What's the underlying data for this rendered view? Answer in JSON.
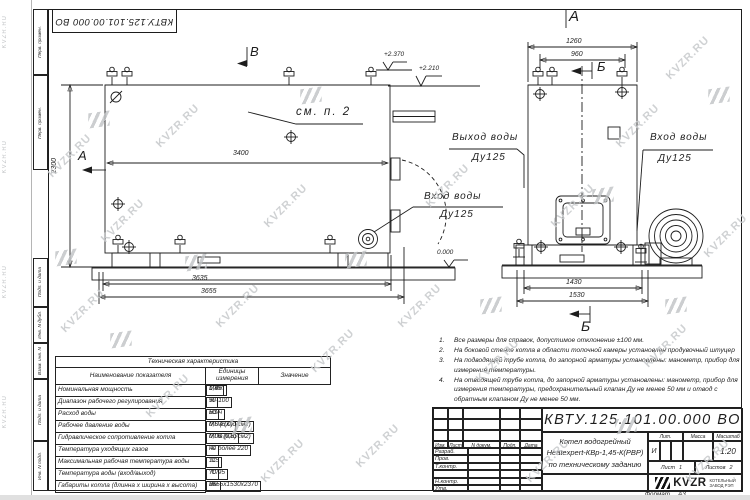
{
  "watermark": "KVZR.RU",
  "top_stamp": {
    "doc_number": "КВТУ.125.101.00.000  ВО"
  },
  "margin_labels": [
    "Перв. примен.",
    "Перв. примен.",
    "Подп. и дата",
    "Инв. N дубл.",
    "Взам. инв. N",
    "Подп. и дата",
    "Инв. N подл."
  ],
  "left_view": {
    "mark_a": "А",
    "mark_v": "В",
    "see_note": "см. п. 2",
    "elev_high": "+2.370",
    "elev_mid": "+2.210",
    "elev_zero": "0.000",
    "inlet_label": "Вход воды",
    "inlet_dn": "Ду125",
    "dim_height": "2300",
    "dim_3400": "3400",
    "dim_3635": "3635",
    "dim_3655": "3655"
  },
  "right_view": {
    "view_label": "А",
    "section_top": "Б",
    "section_bottom": "Б",
    "outlet_label": "Выход воды",
    "outlet_dn": "Ду125",
    "inlet_label": "Вход воды",
    "inlet_dn": "Ду125",
    "dim_1260": "1260",
    "dim_960": "960",
    "dim_1430": "1430",
    "dim_1530": "1530"
  },
  "tech_table": {
    "title": "Техническая характеристика",
    "headers": [
      "Наименование показателя",
      "Единицы измерения",
      "Значение"
    ],
    "rows": [
      [
        "Номинальная мощность",
        "МВт",
        "1,45"
      ],
      [
        "Диапазон рабочего регулирования",
        "%",
        "50-100"
      ],
      [
        "Расход воды",
        "м3/ч",
        "50"
      ],
      [
        "Рабочее давление воды",
        "МПа (кгс/см2)",
        "0,6 (6,0)"
      ],
      [
        "Гидравлическое сопротивление котла",
        "МПа (кгс/см2)",
        "0,06 (0,6)"
      ],
      [
        "Температура уходящих газов",
        "°С",
        "не более 220"
      ],
      [
        "Максимальная рабочая температура воды",
        "°С",
        "115"
      ],
      [
        "Температура воды (вход/выход)",
        "°С",
        "70/95"
      ],
      [
        "Габариты котла (длинна х ширина х высота)",
        "мм",
        "3655х1530х2370"
      ]
    ]
  },
  "notes": [
    {
      "n": "1.",
      "text": "Все размеры для справок, допустимое отклонение ±100 мм."
    },
    {
      "n": "2.",
      "text": "На боковой стенке котла в области топочной камеры установлен продувочный штуцер"
    },
    {
      "n": "3.",
      "text": "На  подводящей трубе котла, до запорной арматуры установлены: манометр, прибор для измерения температуры."
    },
    {
      "n": "4.",
      "text": "На отводящей трубе котла, до запорной арматуры установлены: манометр, прибор для измерения температуры, предохранительный клапан Ду не менее 50 мм и отвод с обратным клапаном Ду не менее 50 мм."
    }
  ],
  "title_block": {
    "doc_number": "КВТУ.125.101.00.000  ВО",
    "header_cols": [
      "Изм.",
      "Лист",
      "N докум.",
      "Подп.",
      "Дата"
    ],
    "row_labels": [
      "Разраб.",
      "Пров.",
      "Т.контр.",
      "Н.контр.",
      "Утв."
    ],
    "description": [
      "Котел водогрейный",
      "Heatexpert-КВр-1,45-К(РВР)",
      "по техническому заданию"
    ],
    "lit_header": "Лит.",
    "mass_header": "Масса",
    "scale_header": "Масштаб",
    "lit_value": "И",
    "scale_value": "1:20",
    "sheet_label": "Лист",
    "sheet_value": "1",
    "sheets_label": "Листов",
    "sheets_value": "2",
    "company_name": "KVZR",
    "company_sub1": "КОТЕЛЬНЫЙ",
    "company_sub2": "ЗАВОД РЭП",
    "format_label": "Формат",
    "format_value": "А3"
  }
}
